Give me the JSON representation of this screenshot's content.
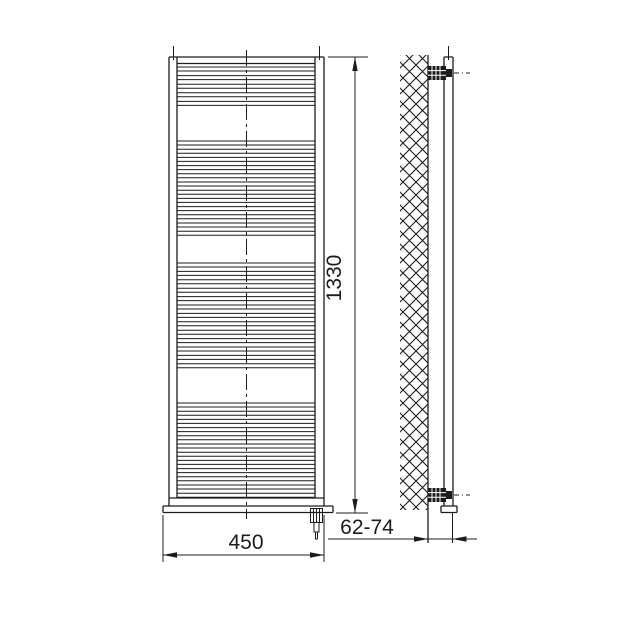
{
  "page": {
    "background_color": "#ffffff",
    "line_color": "#1c1c1c"
  },
  "diagram": {
    "type": "technical-drawing",
    "subject": "ladder towel radiator with electric heating element, front view and wall-mounted side view",
    "dimensions": {
      "height": {
        "label": "1330"
      },
      "width": {
        "label": "450"
      },
      "wall_distance": {
        "label": "62-74"
      }
    },
    "front_view": {
      "rungs": {
        "x1": 177,
        "x2": 315,
        "rung_height": 4,
        "groups": [
          {
            "y_start": 67,
            "count": 5,
            "pitch": 8.6
          },
          {
            "y_start": 141,
            "count": 12,
            "pitch": 8.2
          },
          {
            "y_start": 263,
            "count": 13,
            "pitch": 8.4
          },
          {
            "y_start": 403,
            "count": 12,
            "pitch": 8.2
          }
        ]
      }
    },
    "side_view": {
      "bracket_count": 2
    }
  }
}
